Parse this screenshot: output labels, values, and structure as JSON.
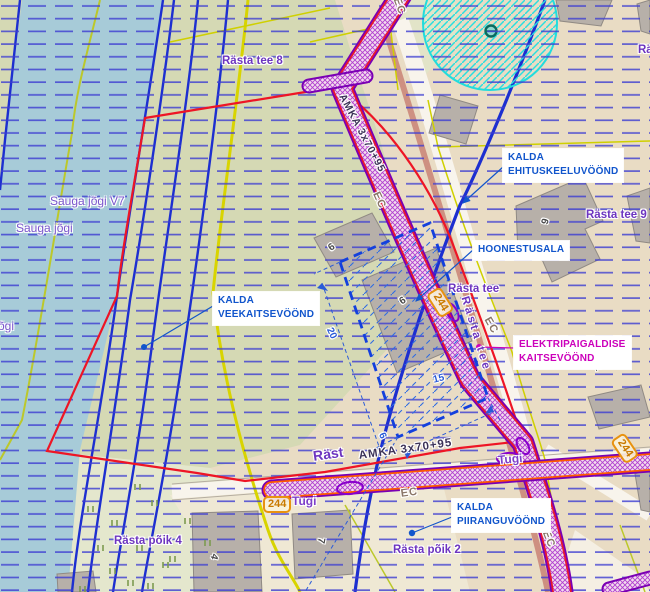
{
  "map_type": "planning-map",
  "streets": [
    "Rästa tee 8",
    "Rästa tee 9",
    "Rä",
    "Rästa tee",
    "Rästa tee",
    "e 6",
    "Rästa põik 4",
    "Rästa põik 2",
    "Räst",
    "Sauga jõgi V7",
    "Sauga jõgi",
    "õgi"
  ],
  "annotations": {
    "ehituskeeluvoond": {
      "line1": "KALDA",
      "line2": "EHITUSKEELUVÖÖND"
    },
    "hoonestusala": {
      "line1": "HOONESTUSALA"
    },
    "veekaitsevoond": {
      "line1": "KALDA",
      "line2": "VEEKAITSEVÖÖND"
    },
    "elektripaigaldise": {
      "line1": "ELEKTRIPAIGALDISE",
      "line2": "KAITSEVÖÖND"
    },
    "piiranguvoond": {
      "line1": "KALDA",
      "line2": "PIIRANGUVÖÖND"
    }
  },
  "utility": {
    "cable": "AMKA 3x70+95",
    "ec": "EC",
    "tugi": "Tugi",
    "pole": "244"
  },
  "dims": {
    "d20": "20",
    "d15": "15",
    "d6": "6"
  },
  "houses": {
    "h6": "6",
    "h9a": "9",
    "h9b": "9",
    "h4": "4",
    "h7a": "7",
    "h7b": "7"
  },
  "colors": {
    "water": "#a7cbd8",
    "land_green": "#d5d9b4",
    "land_tan": "#e9dcc4",
    "hatch_blue": "#3d3dd2",
    "contour_blue": "#1d2fd0",
    "boundary_red": "#ee1525",
    "corridor_purple": "#7a00b4",
    "corridor_orange": "#ff5a00",
    "road_yellow": "#d8d400",
    "annotation_blue": "#1155cc",
    "annotation_magenta": "#cc00bb",
    "street_purple": "#6d35c0",
    "badge_orange": "#e89210",
    "cyan_zone": "#22dcdc"
  }
}
